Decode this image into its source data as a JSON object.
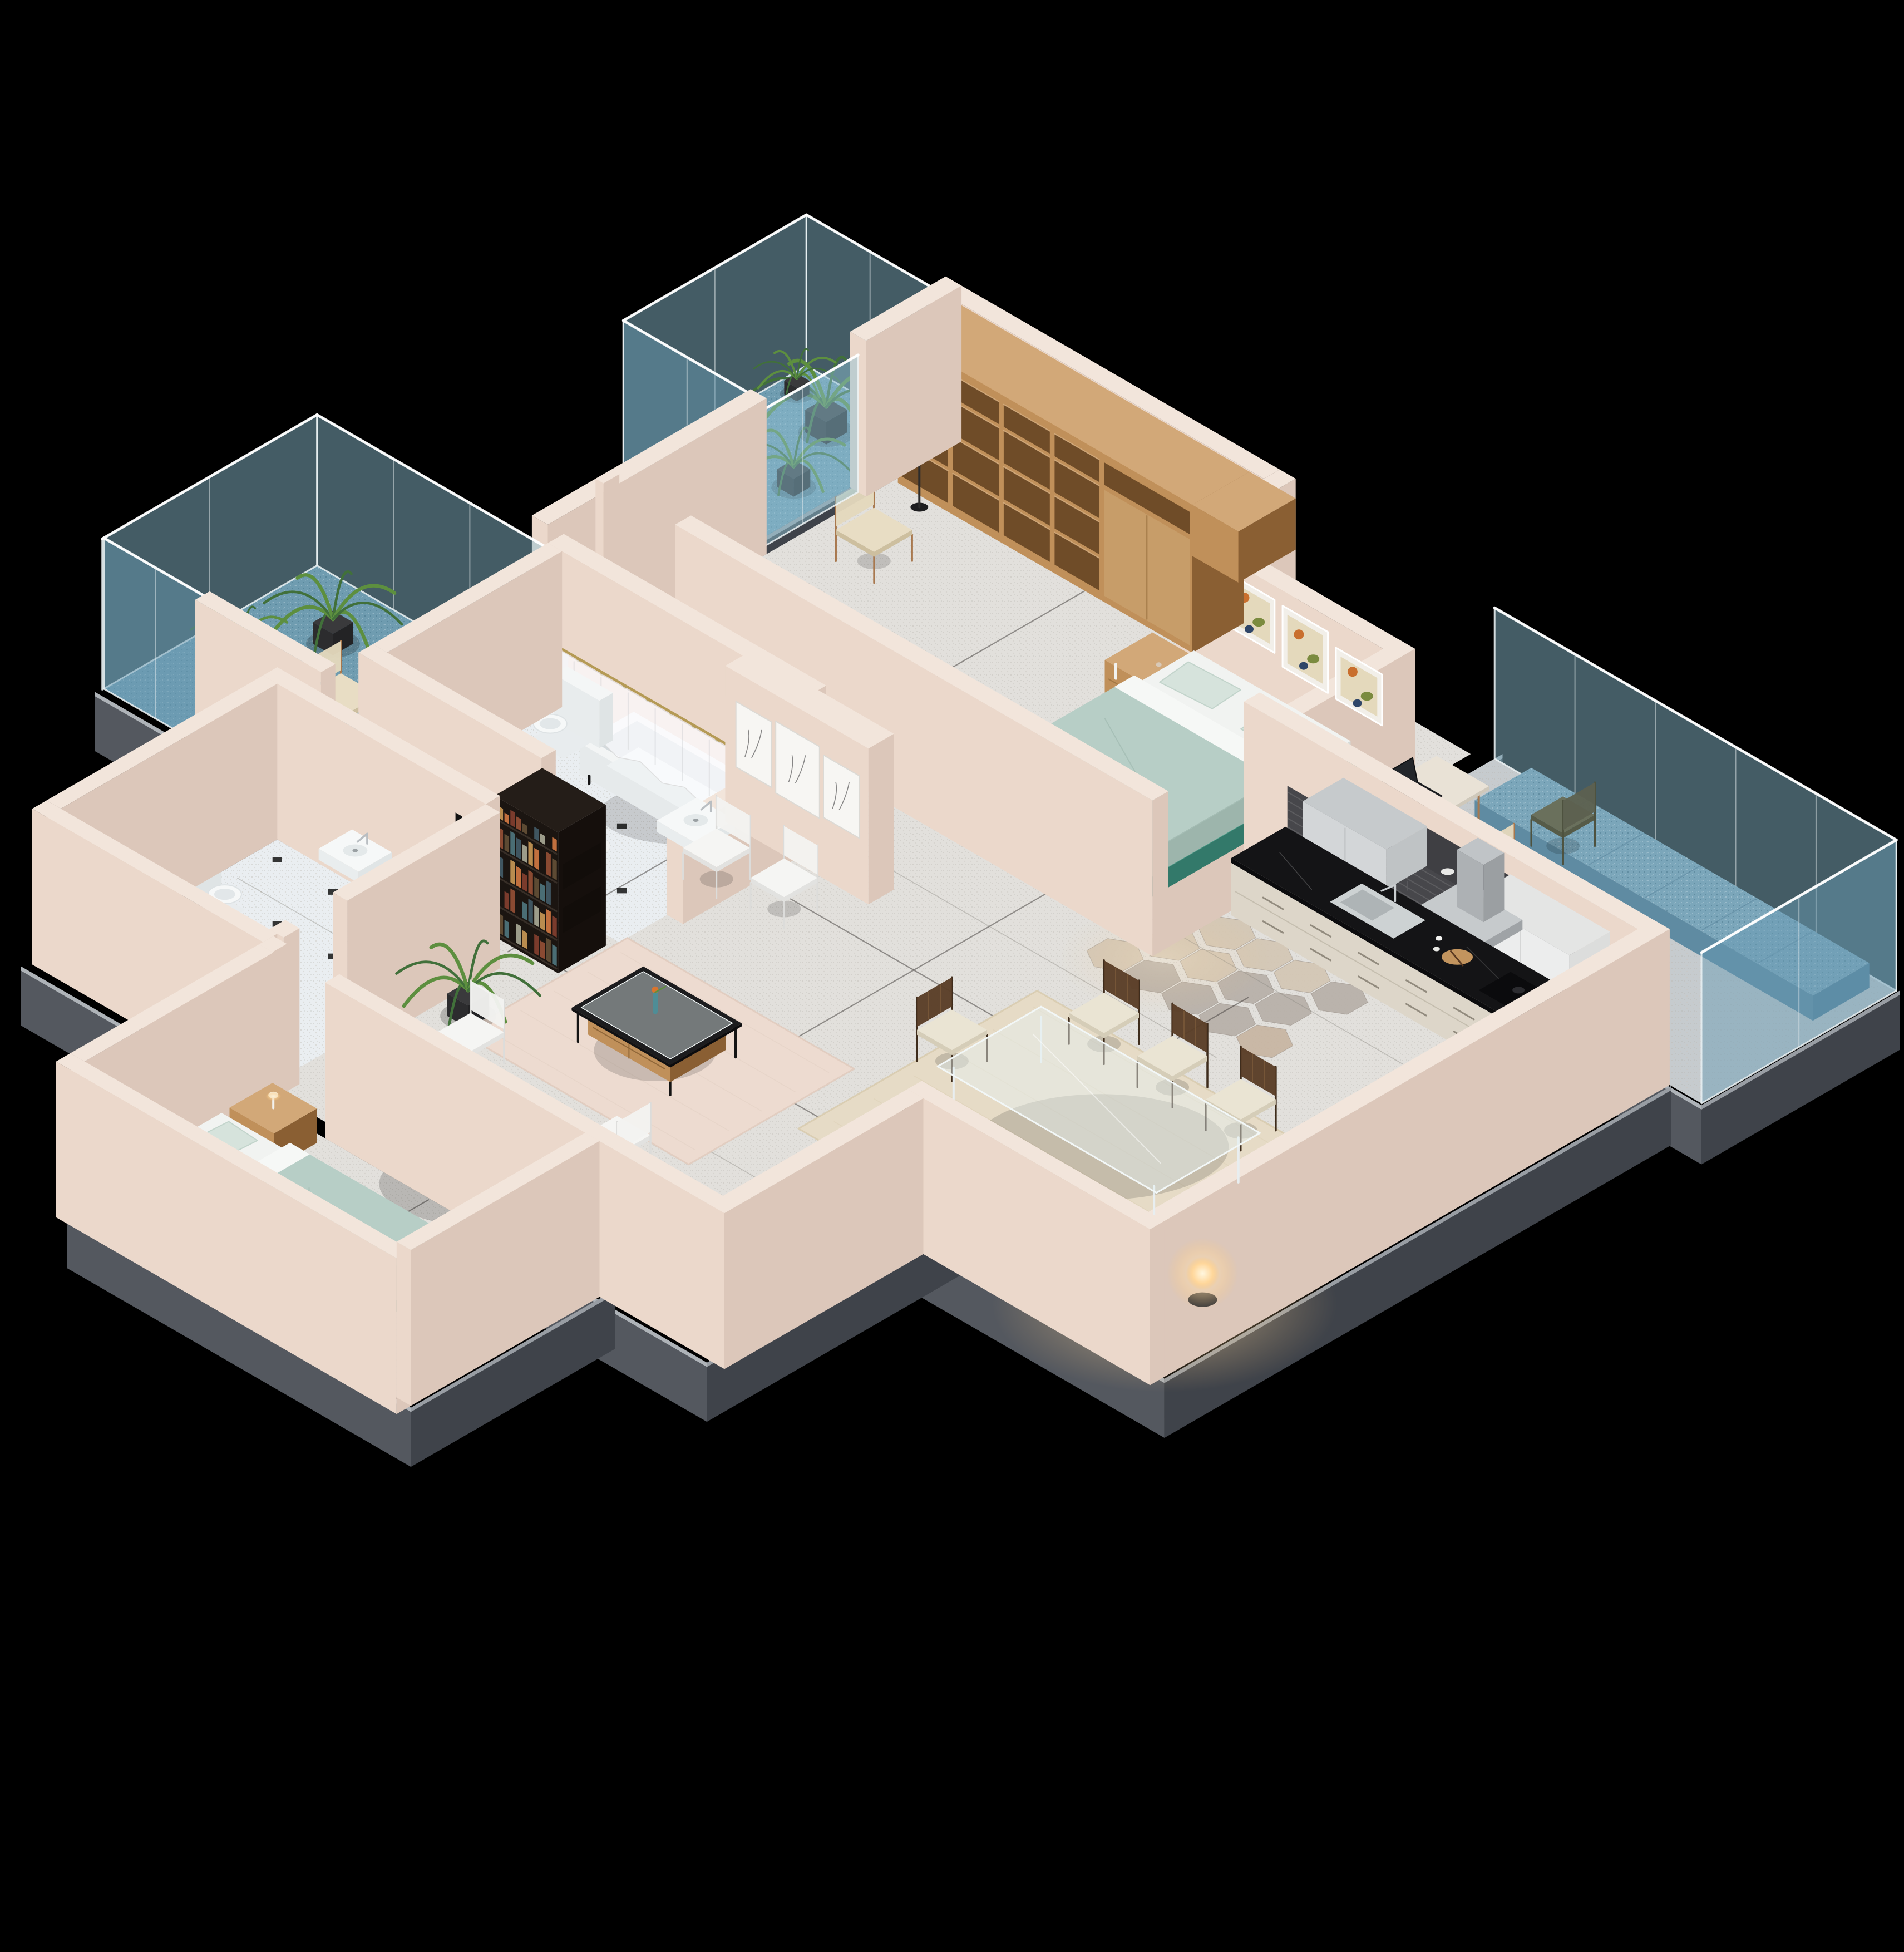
{
  "scene": {
    "kind": "isometric-3d-apartment-floorplan-render",
    "background": "#000000"
  },
  "palette": {
    "bg": "#000000",
    "wallTop": "#f2e5db",
    "wallSW": "#ebd8cb",
    "wallSE": "#dcc7ba",
    "wallExt": "#cdb7aa",
    "plinth1": "#54585f",
    "plinth2": "#3f434a",
    "plinthBand": "#aeb3b8",
    "floorMain": "#e2e0dc",
    "floorBath": "#eaeef1",
    "tileDot": "#141414",
    "balcony": "#6f9cb0",
    "b2floor": "#c6cbce",
    "glass": "#8fc0d4",
    "glassDeep": "#699bb4",
    "glassFrame": "#eef4f6",
    "mint": "#b7cec6",
    "mintDark": "#a4bdb4",
    "mintLight": "#d6e3dc",
    "teal": "#47a18c",
    "sheetWhite": "#f6f8f6",
    "woodLight": "#d2a878",
    "wood": "#c0905a",
    "woodDark": "#8a5f33",
    "woodDeep": "#6f4c28",
    "shelf": "#241d18",
    "shelfSide": "#1b1511",
    "shelfDark": "#150f0c",
    "sofa": "#a3968a",
    "sofaLight": "#b5a89a",
    "pillowDark": "#56493f",
    "cream": "#e9e3d2",
    "counter": "#ece7dd",
    "marble": "#141416",
    "backsplash": "#47474b",
    "upper": "#d3d6d8",
    "upper2": "#eceded",
    "hood": "#b9bdc0",
    "rugDining": "#e6dbc6",
    "rugBlush": "#eddbd0",
    "white": "#f4f5f4",
    "green1": "#41703a",
    "green2": "#5d8f3f",
    "pot": "#2e2e30",
    "seam": "#3b3835",
    "gold": "#b49a55",
    "washerTop": "#2c3035",
    "curtain": "#fcfcff"
  },
  "rooms": [
    {
      "id": "master-balcony",
      "label": "Master Balcony",
      "floor": "blue-speckle",
      "items": [
        "glass-balustrade",
        "potted-palm",
        "potted-palm",
        "potted-palm"
      ]
    },
    {
      "id": "master-bedroom",
      "label": "Master Bedroom",
      "floor": "terrazzo",
      "items": [
        "wardrobe-shelving",
        "floor-lamp",
        "armchair",
        "nightstand",
        "double-bed-mint",
        "wall-art-frames-3",
        "potted-palm",
        "glass-door"
      ]
    },
    {
      "id": "right-balcony",
      "label": "Right Balcony",
      "floor": "grey-tile",
      "items": [
        "glass-balustrade",
        "bench-cushion-blue",
        "desk",
        "laptop",
        "desk-chair",
        "side-chair"
      ]
    },
    {
      "id": "kitchen",
      "label": "Kitchen",
      "floor": "hex-tile",
      "items": [
        "base-cabinets",
        "black-stone-countertop",
        "sink",
        "faucet",
        "cutting-board",
        "cooktop",
        "tile-backsplash",
        "upper-cabinets",
        "range-hood"
      ]
    },
    {
      "id": "bathroom",
      "label": "Bathroom",
      "floor": "diamond-tile",
      "items": [
        "bathtub",
        "shower-curtain",
        "curtain-rod",
        "toilet",
        "wall-sink",
        "bath-mat"
      ]
    },
    {
      "id": "left-balcony",
      "label": "Left Balcony",
      "floor": "blue-speckle",
      "items": [
        "glass-balustrade",
        "potted-palm",
        "potted-palm",
        "armchair"
      ]
    },
    {
      "id": "hall-art-wall",
      "label": "Hall Art Wall",
      "floor": "terrazzo",
      "items": [
        "sketch-panels-3",
        "white-chair",
        "white-chair"
      ]
    },
    {
      "id": "dining-area",
      "label": "Dining Area",
      "floor": "terrazzo",
      "items": [
        "area-rug",
        "glass-dining-table",
        "dining-chair",
        "dining-chair",
        "dining-chair",
        "dining-chair",
        "dining-chair",
        "dining-chair",
        "dining-chair",
        "glowing-floor-lamp"
      ]
    },
    {
      "id": "tv-wall",
      "label": "TV Wall",
      "floor": "terrazzo",
      "items": [
        "tv-console",
        "television-aurora",
        "bookshelf-books"
      ]
    },
    {
      "id": "wc-laundry",
      "label": "WC / Laundry",
      "floor": "diamond-tile",
      "items": [
        "toilet",
        "wall-sink",
        "washing-machine"
      ]
    },
    {
      "id": "living-room",
      "label": "Living Room",
      "floor": "terrazzo",
      "items": [
        "potted-palm",
        "white-chair",
        "area-rug-blush",
        "coffee-table-glass",
        "vase-with-flower",
        "white-chair",
        "sofa-taupe",
        "striped-pillows",
        "round-side-table",
        "vases"
      ]
    },
    {
      "id": "second-bedroom",
      "label": "Second Bedroom",
      "floor": "terrazzo",
      "items": [
        "nightstand",
        "table-lamp",
        "double-bed-mint",
        "leaning-art-frames"
      ]
    }
  ]
}
